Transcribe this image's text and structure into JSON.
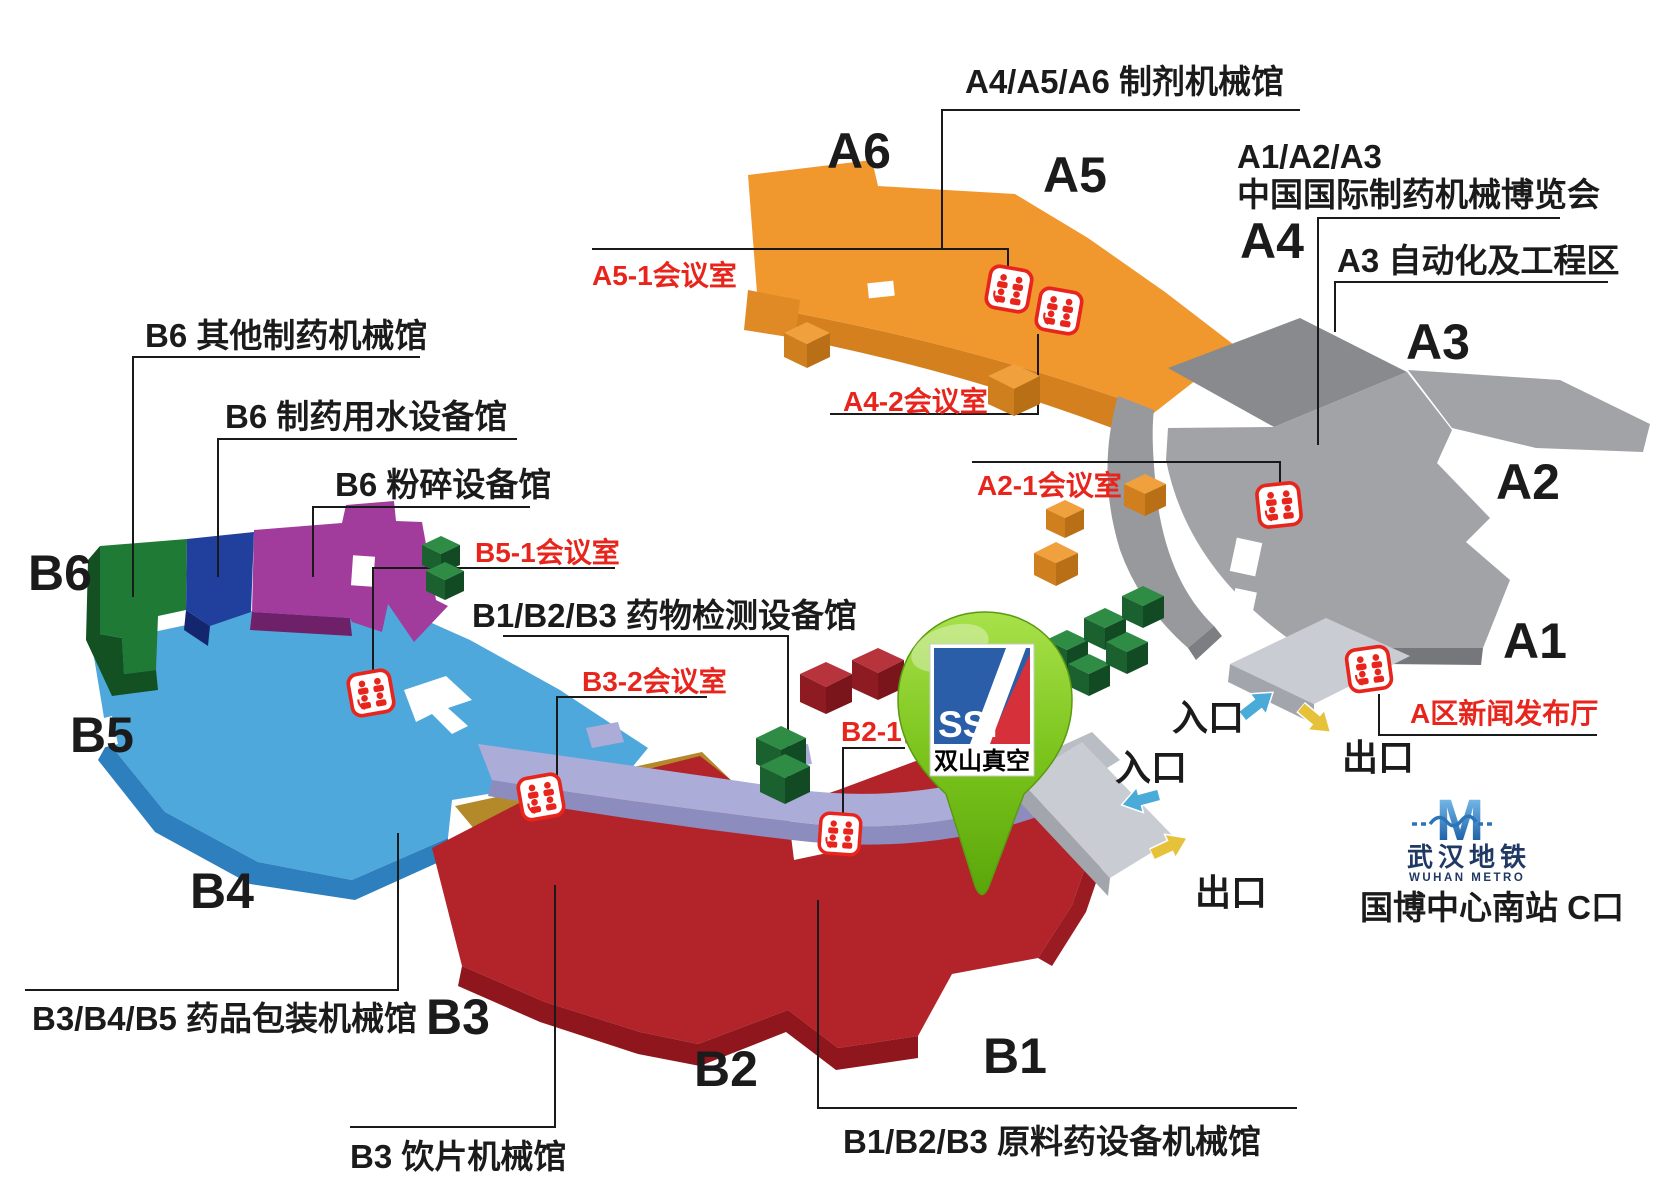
{
  "colors": {
    "hall_a_orange": "#F0982D",
    "hall_a_gray": "#A2A3A7",
    "hall_b_blue": "#4FA8DC",
    "hall_b_red": "#B2232A",
    "hall_b3_gold": "#B3892A",
    "hall_b6_green": "#1E7A35",
    "hall_b6_darkblue": "#21409E",
    "hall_b6_purple": "#A23C9C",
    "corridor_lavender": "#ACACD8",
    "meeting_label_red": "#E8251C",
    "pin_green": "#8CD32C",
    "pin_logo_blue": "#2B5EA8",
    "pin_logo_red": "#D6303A",
    "metro_blue": "#2C74B8",
    "entrance_arrow_blue": "#4AAAD8",
    "exit_arrow_yellow": "#E6C23A"
  },
  "legend": {
    "a456": "A4/A5/A6  制剂机械馆",
    "a123_line1": "A1/A2/A3",
    "a123_line2": "中国国际制药机械博览会",
    "a3_zone": "A3 自动化及工程区",
    "b6_other": "B6  其他制药机械馆",
    "b6_water": "B6  制药用水设备馆",
    "b6_crush": "B6  粉碎设备馆",
    "b123_test": "B1/B2/B3  药物检测设备馆",
    "b345_pack": "B3/B4/B5  药品包装机械馆",
    "b3_slice": "B3  饮片机械馆",
    "b123_api": "B1/B2/B3  原料药设备机械馆"
  },
  "rooms": {
    "a51": "A5-1会议室",
    "a42": "A4-2会议室",
    "a21": "A2-1会议室",
    "b51": "B5-1会议室",
    "b32": "B3-2会议室",
    "b21": "B2-1会议室",
    "a_press": "A区新闻发布厅"
  },
  "halls": {
    "a6": "A6",
    "a5": "A5",
    "a4": "A4",
    "a3": "A3",
    "a2": "A2",
    "a1": "A1",
    "b6": "B6",
    "b5": "B5",
    "b4": "B4",
    "b3": "B3",
    "b2": "B2",
    "b1": "B1"
  },
  "gates": {
    "entrance": "入口",
    "exit": "出口"
  },
  "pin": {
    "acronym": "SSI",
    "company": "双山真空"
  },
  "metro": {
    "letter": "M",
    "name_cn": "武汉地铁",
    "name_en": "WUHAN METRO",
    "station": "国博中心南站 C口"
  }
}
